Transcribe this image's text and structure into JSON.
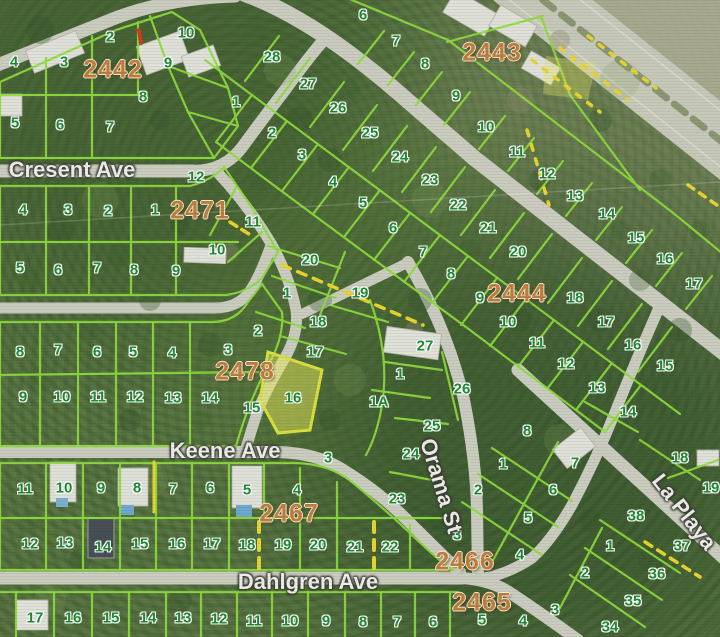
{
  "map_type": "parcel-plat-aerial-map",
  "highlighted_lot": "16",
  "colors": {
    "lot_number": "#1f8a33",
    "block_number": "#bf7e3e",
    "street_text": "#ededE8",
    "parcel_line": "#8edc3c",
    "yellow_dash": "#e8d42e",
    "road": "#c9ccbe",
    "highlight_fill": "#e6e95a"
  },
  "streets": [
    {
      "name": "Cresent Ave",
      "x": 72,
      "y": 170,
      "rotate": 0
    },
    {
      "name": "Keene Ave",
      "x": 225,
      "y": 451,
      "rotate": 0
    },
    {
      "name": "Dahlgren Ave",
      "x": 308,
      "y": 582,
      "rotate": 0
    },
    {
      "name": "Orama St",
      "x": 441,
      "y": 486,
      "rotate": 73
    },
    {
      "name": "La Playa",
      "x": 684,
      "y": 512,
      "rotate": 52
    }
  ],
  "block_numbers": [
    {
      "n": "2442",
      "x": 113,
      "y": 70
    },
    {
      "n": "2443",
      "x": 492,
      "y": 53
    },
    {
      "n": "2471",
      "x": 200,
      "y": 211
    },
    {
      "n": "2444",
      "x": 517,
      "y": 294
    },
    {
      "n": "2478",
      "x": 245,
      "y": 372
    },
    {
      "n": "2467",
      "x": 289,
      "y": 514
    },
    {
      "n": "2466",
      "x": 465,
      "y": 562
    },
    {
      "n": "2465",
      "x": 482,
      "y": 603
    }
  ],
  "lot_numbers": [
    {
      "n": "2",
      "x": 110,
      "y": 37
    },
    {
      "n": "10",
      "x": 186,
      "y": 33
    },
    {
      "n": "4",
      "x": 14,
      "y": 62
    },
    {
      "n": "3",
      "x": 64,
      "y": 62
    },
    {
      "n": "9",
      "x": 168,
      "y": 63
    },
    {
      "n": "8",
      "x": 143,
      "y": 97
    },
    {
      "n": "5",
      "x": 15,
      "y": 123
    },
    {
      "n": "6",
      "x": 60,
      "y": 125
    },
    {
      "n": "7",
      "x": 110,
      "y": 127
    },
    {
      "n": "6",
      "x": 363,
      "y": 15
    },
    {
      "n": "7",
      "x": 396,
      "y": 41
    },
    {
      "n": "8",
      "x": 425,
      "y": 64
    },
    {
      "n": "9",
      "x": 456,
      "y": 96
    },
    {
      "n": "10",
      "x": 486,
      "y": 127
    },
    {
      "n": "11",
      "x": 517,
      "y": 152
    },
    {
      "n": "12",
      "x": 547,
      "y": 174
    },
    {
      "n": "13",
      "x": 575,
      "y": 196
    },
    {
      "n": "14",
      "x": 607,
      "y": 214
    },
    {
      "n": "15",
      "x": 636,
      "y": 238
    },
    {
      "n": "16",
      "x": 665,
      "y": 259
    },
    {
      "n": "17",
      "x": 694,
      "y": 284
    },
    {
      "n": "28",
      "x": 272,
      "y": 57
    },
    {
      "n": "27",
      "x": 308,
      "y": 84
    },
    {
      "n": "26",
      "x": 338,
      "y": 108
    },
    {
      "n": "25",
      "x": 370,
      "y": 133
    },
    {
      "n": "24",
      "x": 400,
      "y": 157
    },
    {
      "n": "23",
      "x": 430,
      "y": 180
    },
    {
      "n": "22",
      "x": 458,
      "y": 205
    },
    {
      "n": "21",
      "x": 488,
      "y": 228
    },
    {
      "n": "20",
      "x": 518,
      "y": 252
    },
    {
      "n": "18",
      "x": 575,
      "y": 298
    },
    {
      "n": "17",
      "x": 606,
      "y": 322
    },
    {
      "n": "16",
      "x": 633,
      "y": 345
    },
    {
      "n": "15",
      "x": 665,
      "y": 366
    },
    {
      "n": "1",
      "x": 236,
      "y": 102
    },
    {
      "n": "2",
      "x": 272,
      "y": 133
    },
    {
      "n": "3",
      "x": 302,
      "y": 155
    },
    {
      "n": "4",
      "x": 333,
      "y": 182
    },
    {
      "n": "5",
      "x": 363,
      "y": 203
    },
    {
      "n": "6",
      "x": 393,
      "y": 228
    },
    {
      "n": "7",
      "x": 423,
      "y": 252
    },
    {
      "n": "8",
      "x": 451,
      "y": 274
    },
    {
      "n": "9",
      "x": 480,
      "y": 298
    },
    {
      "n": "10",
      "x": 508,
      "y": 322
    },
    {
      "n": "11",
      "x": 537,
      "y": 343
    },
    {
      "n": "12",
      "x": 566,
      "y": 364
    },
    {
      "n": "13",
      "x": 597,
      "y": 388
    },
    {
      "n": "14",
      "x": 628,
      "y": 412
    },
    {
      "n": "12",
      "x": 196,
      "y": 177
    },
    {
      "n": "4",
      "x": 23,
      "y": 210
    },
    {
      "n": "3",
      "x": 68,
      "y": 210
    },
    {
      "n": "2",
      "x": 108,
      "y": 211
    },
    {
      "n": "1",
      "x": 155,
      "y": 210
    },
    {
      "n": "11",
      "x": 253,
      "y": 222
    },
    {
      "n": "10",
      "x": 217,
      "y": 250
    },
    {
      "n": "5",
      "x": 20,
      "y": 268
    },
    {
      "n": "6",
      "x": 58,
      "y": 270
    },
    {
      "n": "7",
      "x": 97,
      "y": 268
    },
    {
      "n": "8",
      "x": 134,
      "y": 270
    },
    {
      "n": "9",
      "x": 176,
      "y": 271
    },
    {
      "n": "20",
      "x": 310,
      "y": 260
    },
    {
      "n": "1",
      "x": 287,
      "y": 293
    },
    {
      "n": "19",
      "x": 360,
      "y": 293
    },
    {
      "n": "2",
      "x": 258,
      "y": 331
    },
    {
      "n": "18",
      "x": 318,
      "y": 322
    },
    {
      "n": "17",
      "x": 315,
      "y": 352
    },
    {
      "n": "16",
      "x": 293,
      "y": 398
    },
    {
      "n": "15",
      "x": 252,
      "y": 408
    },
    {
      "n": "27",
      "x": 425,
      "y": 346
    },
    {
      "n": "26",
      "x": 462,
      "y": 389
    },
    {
      "n": "1",
      "x": 400,
      "y": 374
    },
    {
      "n": "1A",
      "x": 379,
      "y": 402
    },
    {
      "n": "25",
      "x": 432,
      "y": 426
    },
    {
      "n": "24",
      "x": 411,
      "y": 454
    },
    {
      "n": "23",
      "x": 397,
      "y": 499
    },
    {
      "n": "3",
      "x": 328,
      "y": 458
    },
    {
      "n": "8",
      "x": 20,
      "y": 352
    },
    {
      "n": "7",
      "x": 58,
      "y": 350
    },
    {
      "n": "6",
      "x": 97,
      "y": 352
    },
    {
      "n": "5",
      "x": 133,
      "y": 352
    },
    {
      "n": "4",
      "x": 172,
      "y": 353
    },
    {
      "n": "3",
      "x": 228,
      "y": 350
    },
    {
      "n": "9",
      "x": 23,
      "y": 397
    },
    {
      "n": "10",
      "x": 62,
      "y": 397
    },
    {
      "n": "11",
      "x": 98,
      "y": 397
    },
    {
      "n": "12",
      "x": 135,
      "y": 397
    },
    {
      "n": "13",
      "x": 173,
      "y": 398
    },
    {
      "n": "14",
      "x": 210,
      "y": 398
    },
    {
      "n": "11",
      "x": 25,
      "y": 489
    },
    {
      "n": "10",
      "x": 64,
      "y": 488
    },
    {
      "n": "9",
      "x": 101,
      "y": 488
    },
    {
      "n": "8",
      "x": 137,
      "y": 488
    },
    {
      "n": "7",
      "x": 173,
      "y": 489
    },
    {
      "n": "6",
      "x": 210,
      "y": 488
    },
    {
      "n": "5",
      "x": 247,
      "y": 490
    },
    {
      "n": "4",
      "x": 297,
      "y": 490
    },
    {
      "n": "12",
      "x": 30,
      "y": 544
    },
    {
      "n": "13",
      "x": 65,
      "y": 543
    },
    {
      "n": "14",
      "x": 103,
      "y": 547
    },
    {
      "n": "15",
      "x": 140,
      "y": 544
    },
    {
      "n": "16",
      "x": 177,
      "y": 544
    },
    {
      "n": "17",
      "x": 212,
      "y": 544
    },
    {
      "n": "18",
      "x": 247,
      "y": 545
    },
    {
      "n": "19",
      "x": 283,
      "y": 545
    },
    {
      "n": "20",
      "x": 318,
      "y": 545
    },
    {
      "n": "21",
      "x": 355,
      "y": 547
    },
    {
      "n": "22",
      "x": 390,
      "y": 547
    },
    {
      "n": "17",
      "x": 35,
      "y": 618
    },
    {
      "n": "16",
      "x": 73,
      "y": 618
    },
    {
      "n": "15",
      "x": 111,
      "y": 618
    },
    {
      "n": "14",
      "x": 148,
      "y": 618
    },
    {
      "n": "13",
      "x": 183,
      "y": 618
    },
    {
      "n": "12",
      "x": 219,
      "y": 619
    },
    {
      "n": "11",
      "x": 254,
      "y": 621
    },
    {
      "n": "10",
      "x": 290,
      "y": 621
    },
    {
      "n": "9",
      "x": 326,
      "y": 621
    },
    {
      "n": "8",
      "x": 363,
      "y": 622
    },
    {
      "n": "7",
      "x": 397,
      "y": 622
    },
    {
      "n": "6",
      "x": 433,
      "y": 622
    },
    {
      "n": "8",
      "x": 527,
      "y": 431
    },
    {
      "n": "1",
      "x": 503,
      "y": 464
    },
    {
      "n": "7",
      "x": 575,
      "y": 463
    },
    {
      "n": "2",
      "x": 478,
      "y": 490
    },
    {
      "n": "6",
      "x": 553,
      "y": 490
    },
    {
      "n": "5",
      "x": 528,
      "y": 518
    },
    {
      "n": "3",
      "x": 457,
      "y": 535
    },
    {
      "n": "4",
      "x": 520,
      "y": 555
    },
    {
      "n": "18",
      "x": 680,
      "y": 458
    },
    {
      "n": "19",
      "x": 711,
      "y": 488
    },
    {
      "n": "38",
      "x": 636,
      "y": 516
    },
    {
      "n": "1",
      "x": 610,
      "y": 546
    },
    {
      "n": "37",
      "x": 682,
      "y": 546
    },
    {
      "n": "2",
      "x": 585,
      "y": 573
    },
    {
      "n": "36",
      "x": 657,
      "y": 574
    },
    {
      "n": "35",
      "x": 633,
      "y": 601
    },
    {
      "n": "34",
      "x": 610,
      "y": 627
    },
    {
      "n": "3",
      "x": 555,
      "y": 610
    },
    {
      "n": "4",
      "x": 523,
      "y": 621
    },
    {
      "n": "5",
      "x": 482,
      "y": 620
    }
  ]
}
